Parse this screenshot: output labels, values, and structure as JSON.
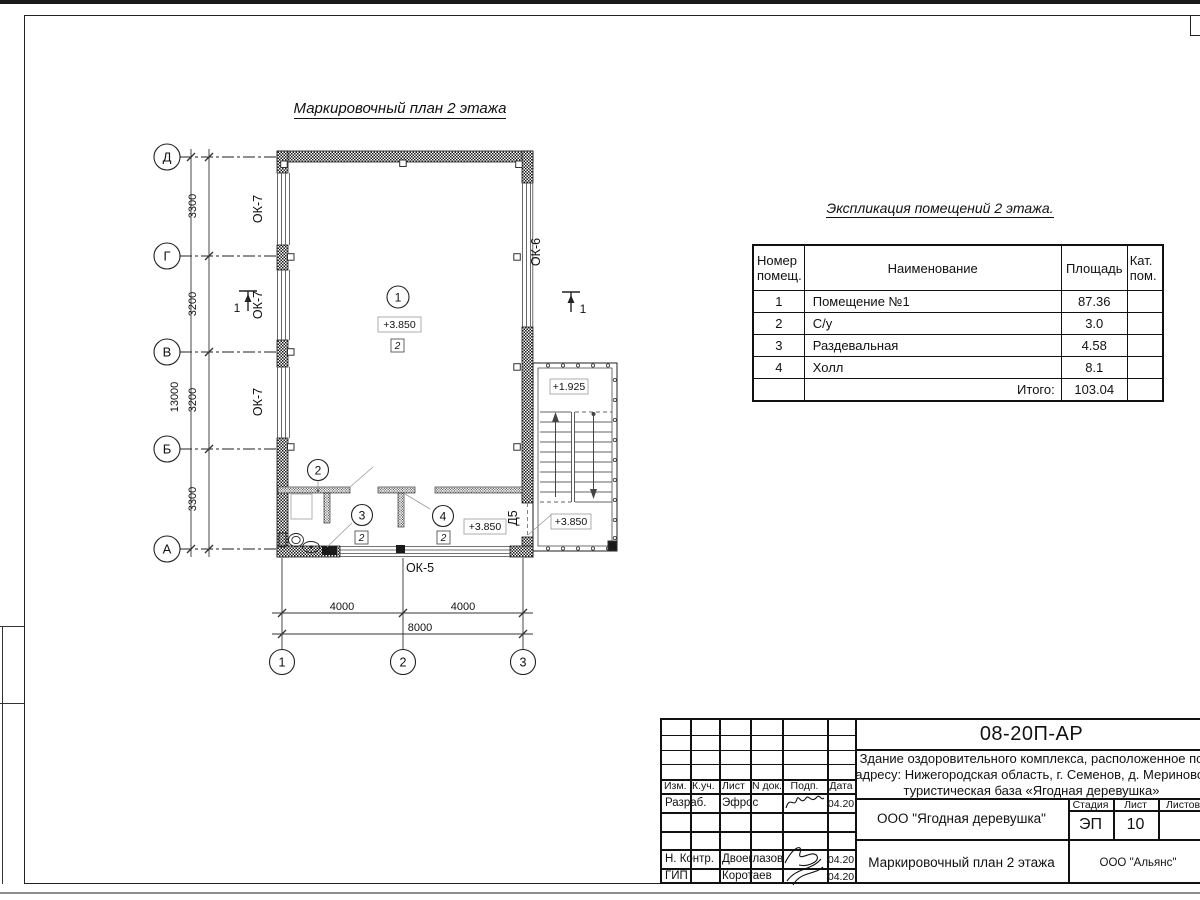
{
  "plan": {
    "title": "Маркировочный план 2 этажа",
    "axes_rows": [
      "Д",
      "Г",
      "В",
      "Б",
      "А"
    ],
    "axes_cols": [
      "1",
      "2",
      "3"
    ],
    "dims_v": [
      "3300",
      "3200",
      "3200",
      "3300"
    ],
    "dim_v_total": "13000",
    "dims_h": [
      "4000",
      "4000"
    ],
    "dim_h_total": "8000",
    "win_left": "ОК-7",
    "win_right": "ОК-6",
    "win_bottom": "ОК-5",
    "door": "Д5",
    "section": "1",
    "room_numbers": [
      "1",
      "2",
      "3",
      "4"
    ],
    "floor_mark": "2",
    "elev_main": "+3.850",
    "elev_hall": "+3.850",
    "elev_landing": "+1.925",
    "elev_stair": "+3.850"
  },
  "schedule": {
    "title": "Экспликация помещений 2 этажа.",
    "columns": [
      "Номер помещ.",
      "Наименование",
      "Площадь",
      "Кат. пом."
    ],
    "rows": [
      [
        "1",
        "Помещение №1",
        "87.36",
        ""
      ],
      [
        "2",
        "С/у",
        "3.0",
        ""
      ],
      [
        "3",
        "Раздевальная",
        "4.58",
        ""
      ],
      [
        "4",
        "Холл",
        "8.1",
        ""
      ]
    ],
    "total_label": "Итого:",
    "total_value": "103.04"
  },
  "title_block": {
    "doc_number": "08-20П-АР",
    "description_lines": [
      "Здание оздоровительного комплекса, расположенное по",
      "адресу: Нижегородская область, г. Семенов, д. Мериново,",
      "туристическая база «Ягодная деревушка»"
    ],
    "header_cells": [
      "Изм.",
      "К.уч.",
      "Лист",
      "N док.",
      "Подп.",
      "Дата"
    ],
    "rows": [
      {
        "role": "Разраб.",
        "name": "Эфрос",
        "date": "04.20"
      },
      {
        "role": "Н. Контр.",
        "name": "Двоеглазов",
        "date": "04.20"
      },
      {
        "role": "ГИП",
        "name": "Коротаев",
        "date": "04.20"
      }
    ],
    "company": "ООО \"Ягодная деревушка\"",
    "stage_label": "Стадия",
    "sheet_label": "Лист",
    "sheets_label": "Листов",
    "stage": "ЭП",
    "sheet": "10",
    "drawing_title": "Маркировочный план 2 этажа",
    "contractor": "ООО \"Альянс\""
  }
}
